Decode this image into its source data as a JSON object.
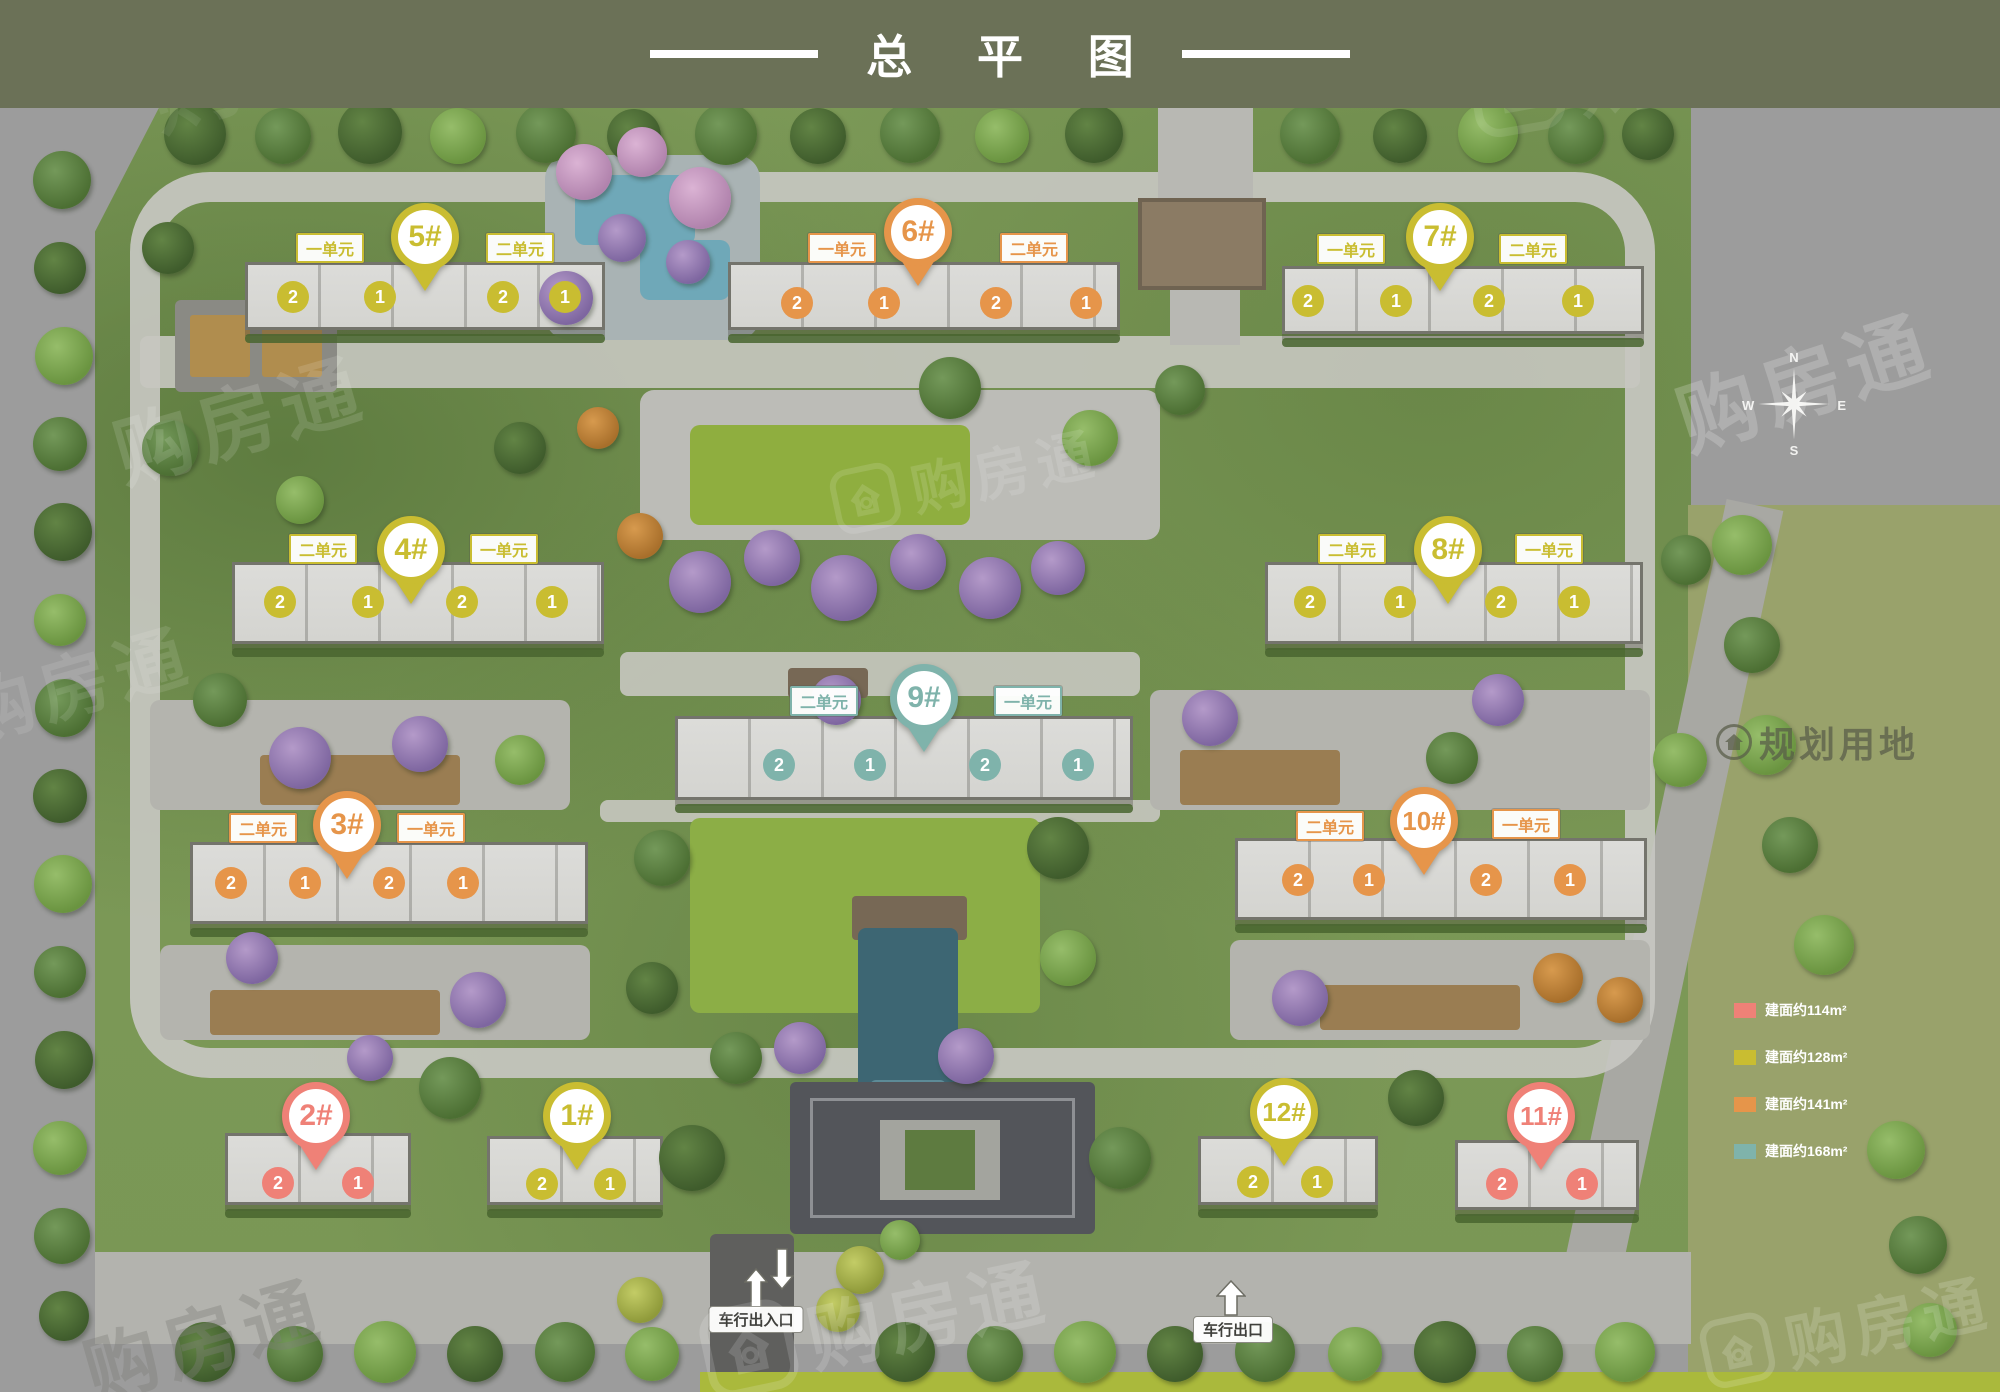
{
  "header": {
    "title": "总 平 图"
  },
  "watermark": {
    "brand": "购房通"
  },
  "compass": {
    "n": "N",
    "w": "W",
    "e": "E",
    "s": "S"
  },
  "map_labels": {
    "vehicle_exit": "车行出口",
    "vehicle_gate": "车行出入口",
    "planned_land": "规划用地"
  },
  "legend": {
    "items": [
      {
        "label": "建面约114m²",
        "color": "#ef8177"
      },
      {
        "label": "建面约128m²",
        "color": "#c9bd31"
      },
      {
        "label": "建面约141m²",
        "color": "#e6954a"
      },
      {
        "label": "建面约168m²",
        "color": "#7fb3ab"
      }
    ]
  },
  "area_colors": {
    "114": "#ef8177",
    "128": "#c9bd31",
    "141": "#e6954a",
    "168": "#7fb3ab"
  },
  "buildings": [
    {
      "id": "1",
      "pin": "1#",
      "area": "128",
      "units": [
        {
          "label": null,
          "circles": [
            "2",
            "1"
          ]
        }
      ]
    },
    {
      "id": "2",
      "pin": "2#",
      "area": "114",
      "units": [
        {
          "label": null,
          "circles": [
            "2",
            "1"
          ]
        }
      ]
    },
    {
      "id": "3",
      "pin": "3#",
      "area": "141",
      "units": [
        {
          "label": "二单元",
          "circles": [
            "2",
            "1"
          ]
        },
        {
          "label": "一单元",
          "circles": [
            "2",
            "1"
          ]
        }
      ]
    },
    {
      "id": "4",
      "pin": "4#",
      "area": "128",
      "units": [
        {
          "label": "二单元",
          "circles": [
            "2",
            "1"
          ]
        },
        {
          "label": "一单元",
          "circles": [
            "2",
            "1"
          ]
        }
      ]
    },
    {
      "id": "5",
      "pin": "5#",
      "area": "128",
      "units": [
        {
          "label": "一单元",
          "circles": [
            "2",
            "1"
          ]
        },
        {
          "label": "二单元",
          "circles": [
            "2",
            "1"
          ]
        }
      ]
    },
    {
      "id": "6",
      "pin": "6#",
      "area": "141",
      "units": [
        {
          "label": "一单元",
          "circles": [
            "2",
            "1"
          ]
        },
        {
          "label": "二单元",
          "circles": [
            "2",
            "1"
          ]
        }
      ]
    },
    {
      "id": "7",
      "pin": "7#",
      "area": "128",
      "units": [
        {
          "label": "一单元",
          "circles": [
            "2",
            "1"
          ]
        },
        {
          "label": "二单元",
          "circles": [
            "2",
            "1"
          ]
        }
      ]
    },
    {
      "id": "8",
      "pin": "8#",
      "area": "128",
      "units": [
        {
          "label": "二单元",
          "circles": [
            "2",
            "1"
          ]
        },
        {
          "label": "一单元",
          "circles": [
            "2",
            "1"
          ]
        }
      ]
    },
    {
      "id": "9",
      "pin": "9#",
      "area": "168",
      "units": [
        {
          "label": "二单元",
          "circles": [
            "2",
            "1"
          ]
        },
        {
          "label": "一单元",
          "circles": [
            "2",
            "1"
          ]
        }
      ]
    },
    {
      "id": "10",
      "pin": "10#",
      "area": "141",
      "units": [
        {
          "label": "二单元",
          "circles": [
            "2",
            "1"
          ]
        },
        {
          "label": "一单元",
          "circles": [
            "2",
            "1"
          ]
        }
      ]
    },
    {
      "id": "11",
      "pin": "11#",
      "area": "114",
      "units": [
        {
          "label": null,
          "circles": [
            "2",
            "1"
          ]
        }
      ]
    },
    {
      "id": "12",
      "pin": "12#",
      "area": "128",
      "units": [
        {
          "label": null,
          "circles": [
            "2",
            "1"
          ]
        }
      ]
    }
  ]
}
